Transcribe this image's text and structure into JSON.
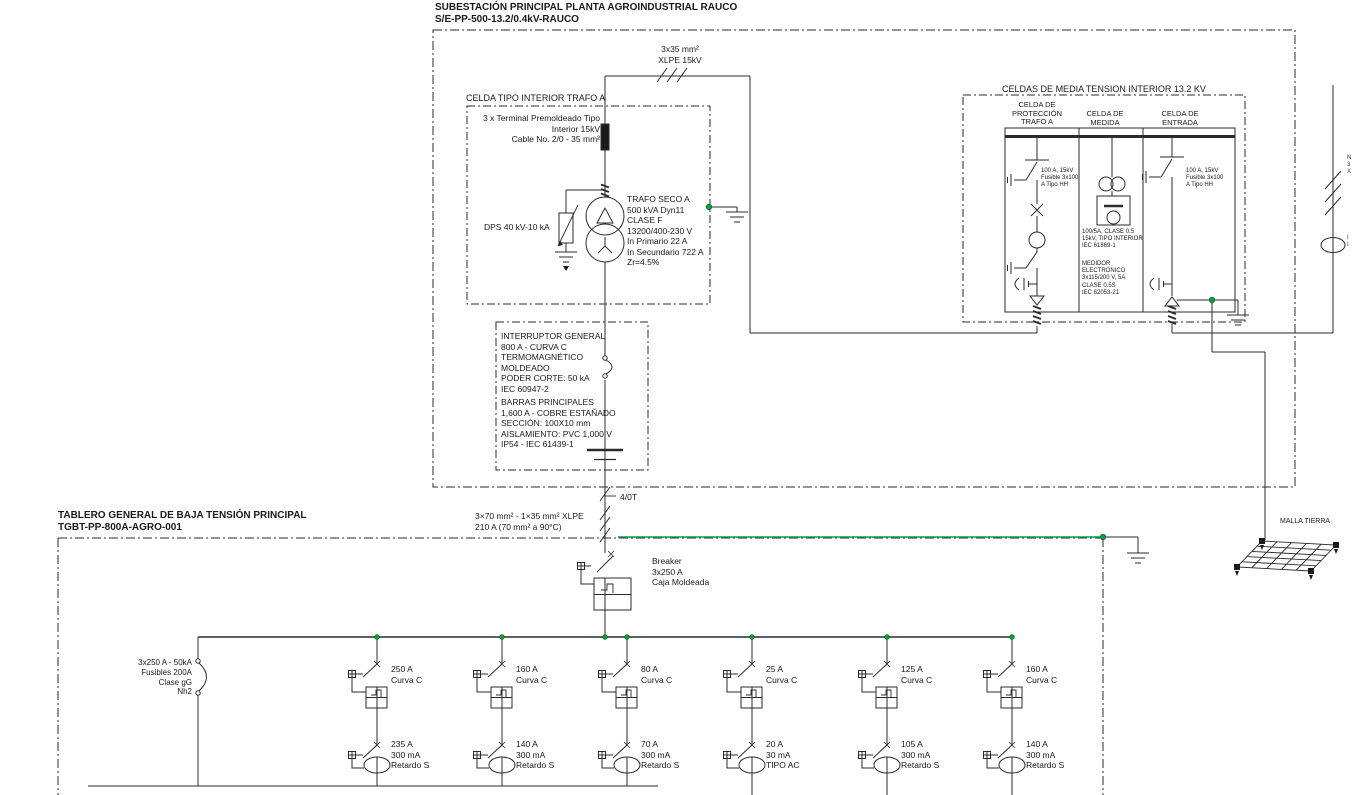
{
  "diagram": {
    "title": "SUBESTACIÓN PRINCIPAL PLANTA AGROINDUSTRIAL RAUCO\nS/E-PP-500-13.2/0.4kV-RAUCO",
    "mv_cable_label": "3x35 mm²\nXLPE 15kV",
    "celda_trafo": {
      "title": "CELDA TIPO INTERIOR TRAFO A",
      "terminal": "3 x Terminal Premoldeado Tipo\nInterior 15kV\nCable No. 2/0 - 35 mm²",
      "dps": "DPS 40 kV-10 kA",
      "trafo": "TRAFO SECO A\n500 kVA Dyn11\nCLASE F\n13200/400-230 V\nIn Primario 22 A\nIn Secundario 722 A\nZr=4.5%"
    },
    "celdas_mt": {
      "title": "CELDAS DE MEDIA TENSION INTERIOR 13.2 KV",
      "cell_proteccion": {
        "header": "CELDA DE\nPROTECCIÓN\nTRAFO A",
        "fuse": "100 A, 15kV\nFusible 3x100\nA Tipo HH"
      },
      "cell_medida": {
        "header": "CELDA DE\nMEDIDA",
        "ct": "100/5A, CLASE 0.5\n15kV, TIPO INTERIOR\nIEC 61869-1",
        "medidor": "MEDIDOR\nELECTRÓNICO\n3x115/200 V, 5A\nCLASE 0.5S\nIEC 62053-21"
      },
      "cell_entrada": {
        "header": "CELDA DE\nENTRADA",
        "fuse": "100 A, 15kV\nFusible 3x100\nA Tipo HH"
      }
    },
    "interruptor_general": "INTERRUPTOR GENERAL\n800 A - CURVA C\nTERMOMAGNÉTICO\nMOLDEADO\nPODER CORTE: 50 kA\nIEC 60947-2",
    "barras": "BARRAS PRINCIPALES\n1,600 A - COBRE ESTAÑADO\nSECCIÓN: 100X10 mm\nAISLAMIENTO: PVC 1,000 V\nIP54 - IEC 61439-1",
    "lv_cable": {
      "tap": "4/0T",
      "label": "3×70 mm² - 1×35 mm² XLPE\n210 A (70 mm² a 90°C)"
    },
    "tgbt": {
      "title": "TABLERO GENERAL DE BAJA TENSIÓN PRINCIPAL\nTGBT-PP-800A-AGRO-001",
      "main_breaker": "Breaker\n3x250 A\nCaja Moldeada",
      "fuse_switch": "3x250 A - 50kA\nFusibles 200A\nClase gG\nNh2",
      "feeders": [
        {
          "mccb": "250 A\nCurva C",
          "rcd": "235 A\n300 mA\nRetardo S"
        },
        {
          "mccb": "160 A\nCurva C",
          "rcd": "140 A\n300 mA\nRetardo S"
        },
        {
          "mccb": "80 A\nCurva C",
          "rcd": "70 A\n300 mA\nRetardo S"
        },
        {
          "mccb": "25 A\nCurva C",
          "rcd": "20 A\n30 mA\nTIPO AC"
        },
        {
          "mccb": "125 A\nCurva C",
          "rcd": "105 A\n300 mA\nRetardo S"
        },
        {
          "mccb": "160 A\nCurva C",
          "rcd": "140 A\n300 mA\nRetardo S"
        }
      ]
    },
    "malla_tierra": "MALLA TIERRA",
    "edge_fragments": {
      "top": "N\n3\nX",
      "bottom": "I\nI"
    },
    "colors": {
      "line": "#2b2b2b",
      "earth_green": "#00a33e",
      "background": "#ffffff"
    }
  }
}
